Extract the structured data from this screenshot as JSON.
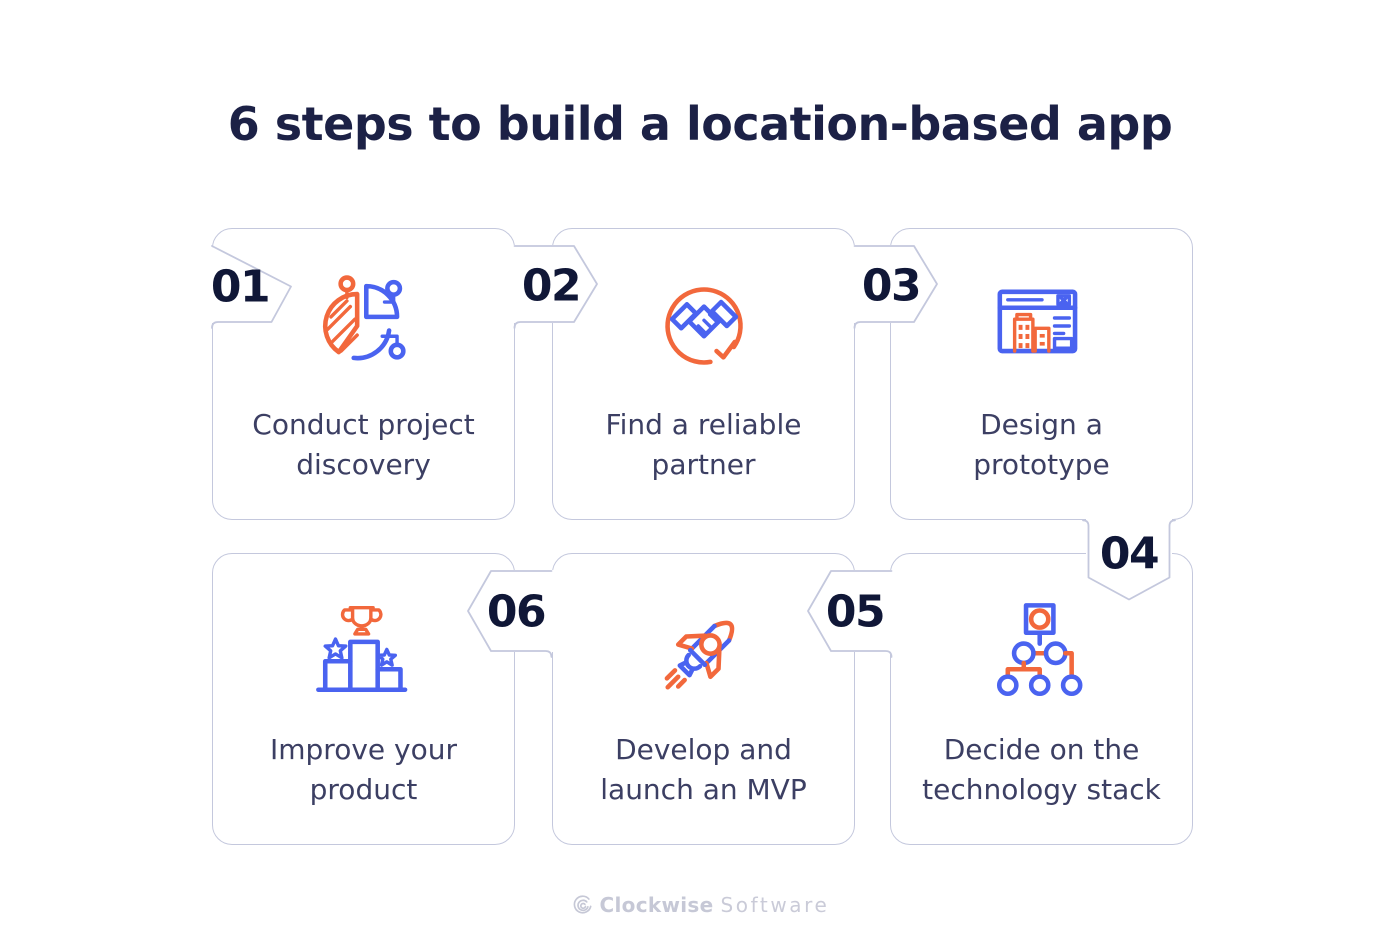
{
  "title": "6 steps to build a location-based app",
  "steps": [
    {
      "number": "01",
      "label": "Conduct project\ndiscovery",
      "icon": "pie-chart"
    },
    {
      "number": "02",
      "label": "Find a reliable\npartner",
      "icon": "handshake"
    },
    {
      "number": "03",
      "label": "Design a\nprototype",
      "icon": "browser-prototype"
    },
    {
      "number": "04",
      "label": "Decide on the\ntechnology stack",
      "icon": "hierarchy"
    },
    {
      "number": "05",
      "label": "Develop and\nlaunch an MVP",
      "icon": "rocket"
    },
    {
      "number": "06",
      "label": "Improve your\nproduct",
      "icon": "podium-trophy"
    }
  ],
  "footer": {
    "brand_bold": "Clockwise",
    "brand_light": "Software"
  },
  "colors": {
    "accent_blue": "#4a63f0",
    "accent_orange": "#f2683c",
    "card_border": "#c4c8dd",
    "number_color": "#101737",
    "title_color": "#1c2146",
    "label_color": "#3c3f63",
    "footer_color": "#c6c8d6"
  }
}
